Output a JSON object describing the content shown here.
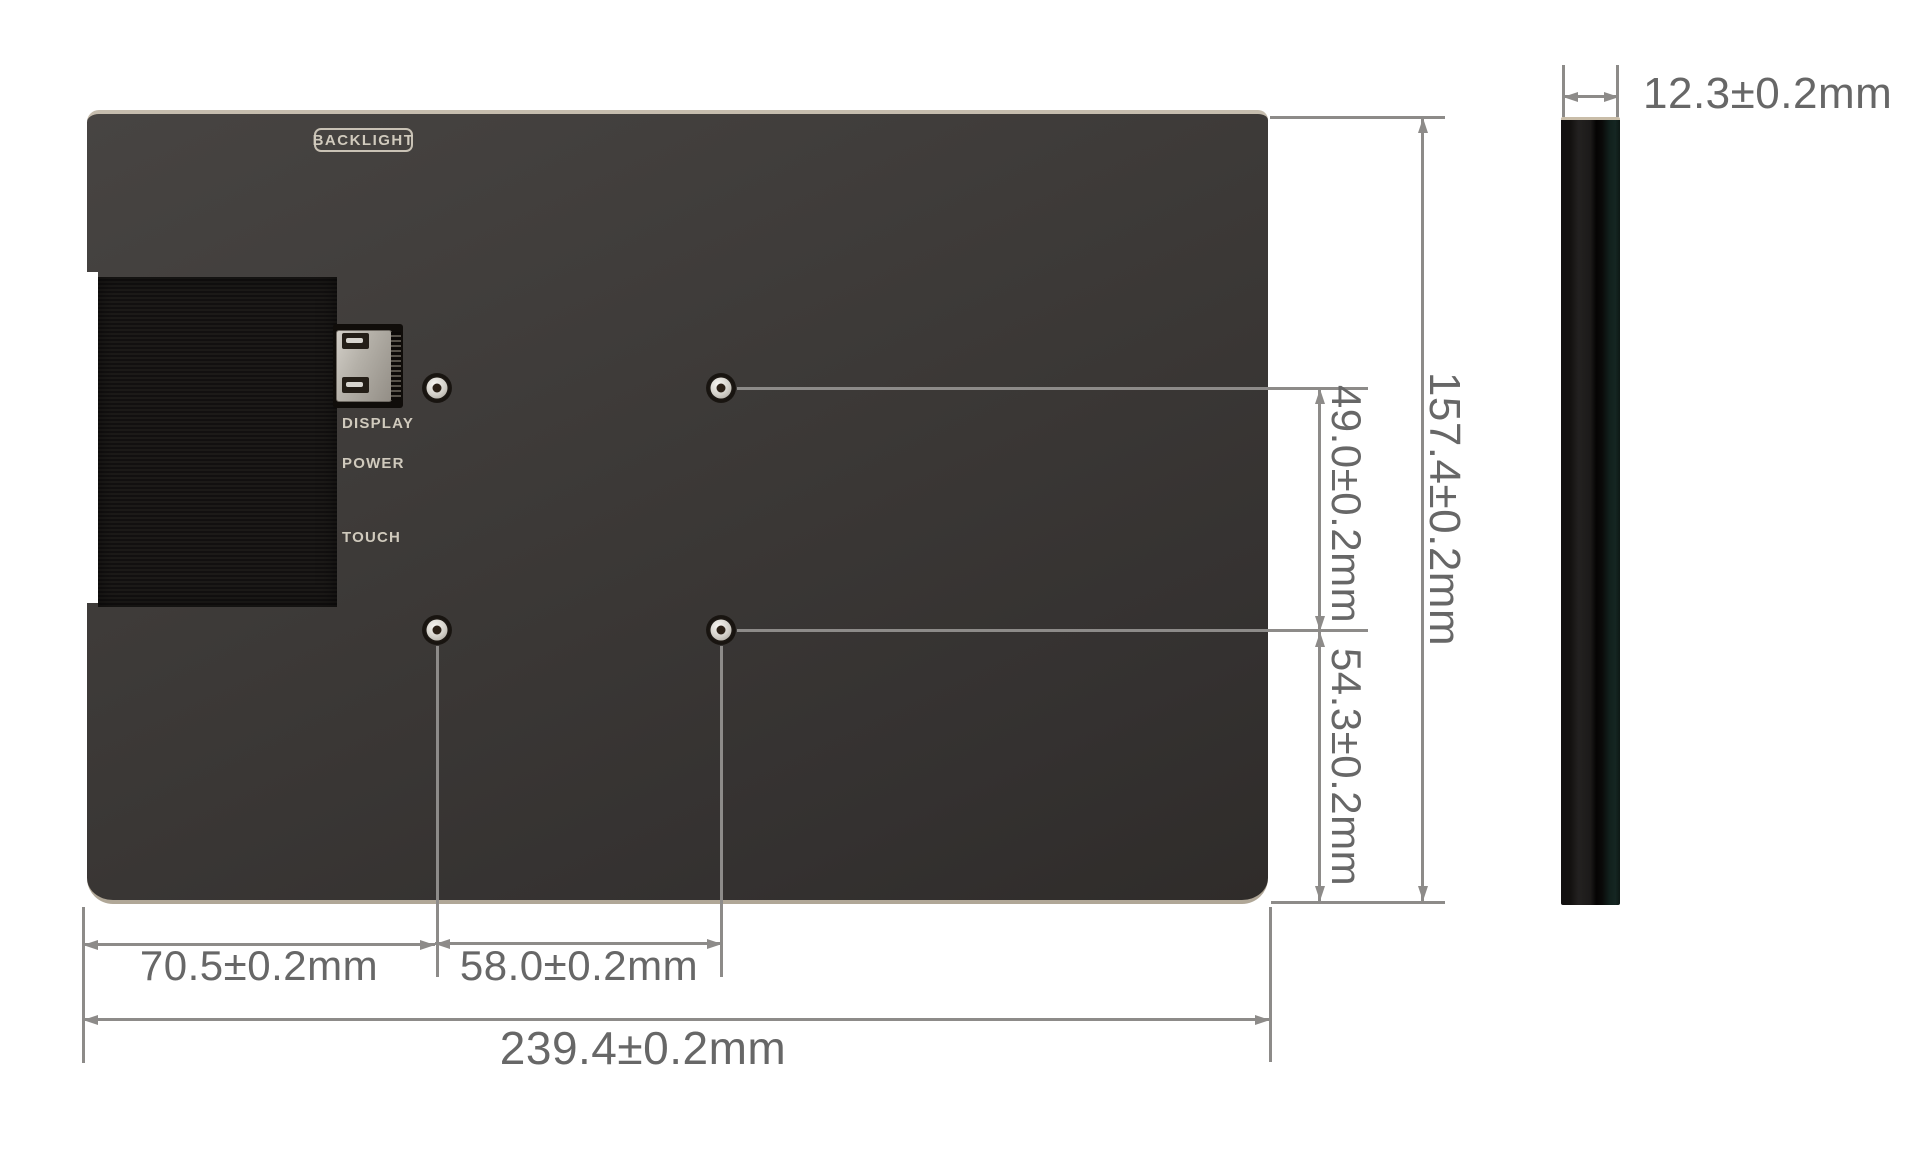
{
  "diagram": {
    "type": "mechanical-dimension-drawing",
    "back": {
      "backlight_badge": "BACKLIGHT",
      "port_labels": [
        "DISPLAY",
        "POWER",
        "TOUCH"
      ]
    },
    "dims": {
      "overall_width": "239.4±0.2mm",
      "overall_height": "157.4±0.2mm",
      "thickness": "12.3±0.2mm",
      "hole_left_offset": "70.5±0.2mm",
      "hole_spacing_x": "58.0±0.2mm",
      "hole_spacing_y": "49.0±0.2mm",
      "hole_row_to_bottom": "54.3±0.2mm"
    },
    "colors": {
      "panel": "#3d3a38",
      "ribbon_black": "#161412",
      "dimension_line": "#8d8b89",
      "dimension_text": "#676767",
      "panel_label_text": "#d0cabd",
      "background": "#ffffff"
    }
  }
}
